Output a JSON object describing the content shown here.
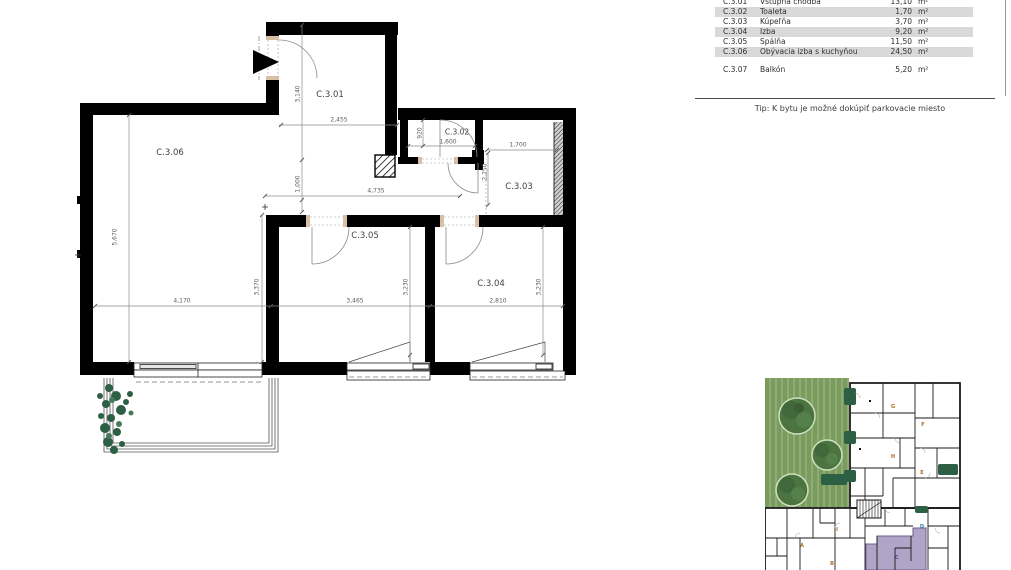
{
  "legend": {
    "rows": [
      {
        "code": "C.3.01",
        "name": "Vstupná chodba",
        "area": "13,10",
        "unit": "m²"
      },
      {
        "code": "C.3.02",
        "name": "Toaleta",
        "area": "1,70",
        "unit": "m²"
      },
      {
        "code": "C.3.03",
        "name": "Kúpeľňa",
        "area": "3,70",
        "unit": "m²"
      },
      {
        "code": "C.3.04",
        "name": "Izba",
        "area": "9,20",
        "unit": "m²"
      },
      {
        "code": "C.3.05",
        "name": "Spálňa",
        "area": "11,50",
        "unit": "m²"
      },
      {
        "code": "C.3.06",
        "name": "Obývacia izba s kuchyňou",
        "area": "24,50",
        "unit": "m²"
      }
    ],
    "balcony_row": {
      "code": "C.3.07",
      "name": "Balkón",
      "area": "5,20",
      "unit": "m²"
    },
    "tip": "Tip:  K bytu je možné dokúpiť parkovacie miesto"
  },
  "floor_plan": {
    "rooms": {
      "c301": "C.3.01",
      "c302": "C.3.02",
      "c303": "C.3.03",
      "c304": "C.3.04",
      "c305": "C.3.05",
      "c306": "C.3.06"
    },
    "dims": {
      "c301_width": "2,455",
      "c301_height": "3,140",
      "c301_opening": "1,000",
      "hallway_width": "4,735",
      "c302_height": "920",
      "c302_width": "1,600",
      "c303_width": "1,700",
      "c303_height": "2,250",
      "c306_height": "5,670",
      "c306_width": "4,170",
      "c306_inner": "3,370",
      "c305_width": "3,465",
      "c305_height": "3,230",
      "c304_width": "2,810",
      "c304_height": "3,230"
    }
  },
  "site_plan": {
    "highlighted_unit": "C",
    "units": {
      "a": "A",
      "b": "B",
      "c": "C",
      "d": "D",
      "e": "E",
      "f": "F",
      "g": "G",
      "h": "H",
      "i": "I"
    }
  },
  "colors": {
    "row_shade": "#d9d9d9",
    "wall": "#000000",
    "door_jamb": "#d9bfa4",
    "lawn": "#7a9b5e",
    "tree": "#4b7440",
    "shrub": "#2d5f45",
    "highlight_unit": "#b1a4c6"
  }
}
